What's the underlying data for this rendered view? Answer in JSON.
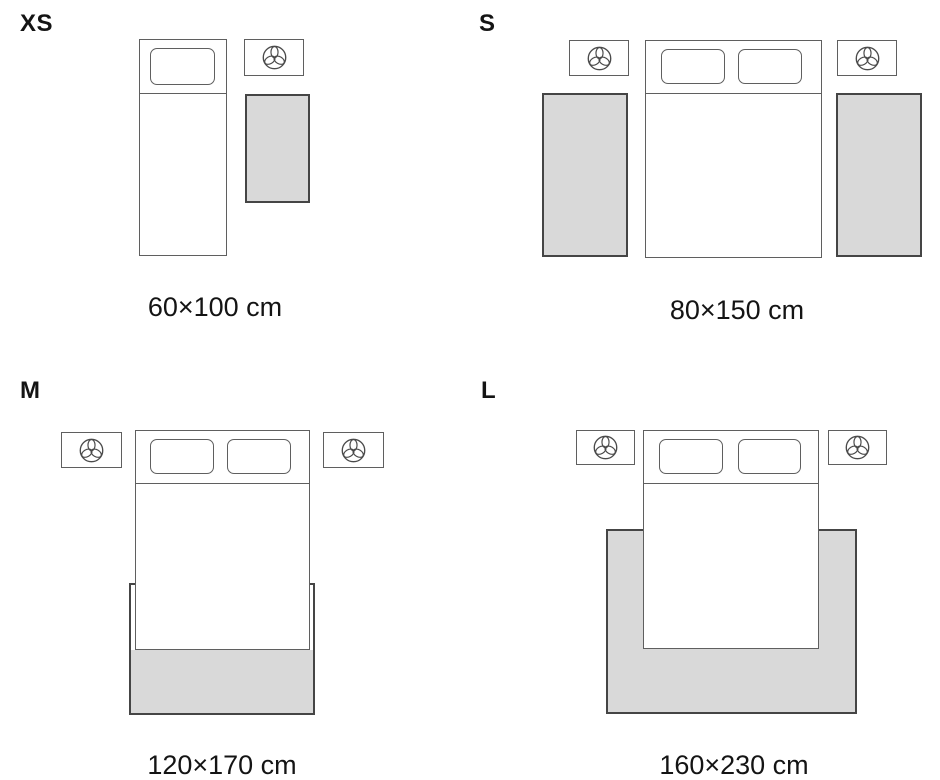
{
  "sizes": [
    {
      "id": "xs",
      "label": "XS",
      "dimensions": "60×100 cm"
    },
    {
      "id": "s",
      "label": "S",
      "dimensions": "80×150 cm"
    },
    {
      "id": "m",
      "label": "M",
      "dimensions": "120×170 cm"
    },
    {
      "id": "l",
      "label": "L",
      "dimensions": "160×230 cm"
    }
  ],
  "icons": {
    "nightstand_decor": "plant-icon"
  },
  "colors": {
    "background": "#ffffff",
    "rug_fill": "#d9d9d9",
    "rug_border": "#454545",
    "furniture_border": "#5f5f5f",
    "text": "#141414"
  }
}
